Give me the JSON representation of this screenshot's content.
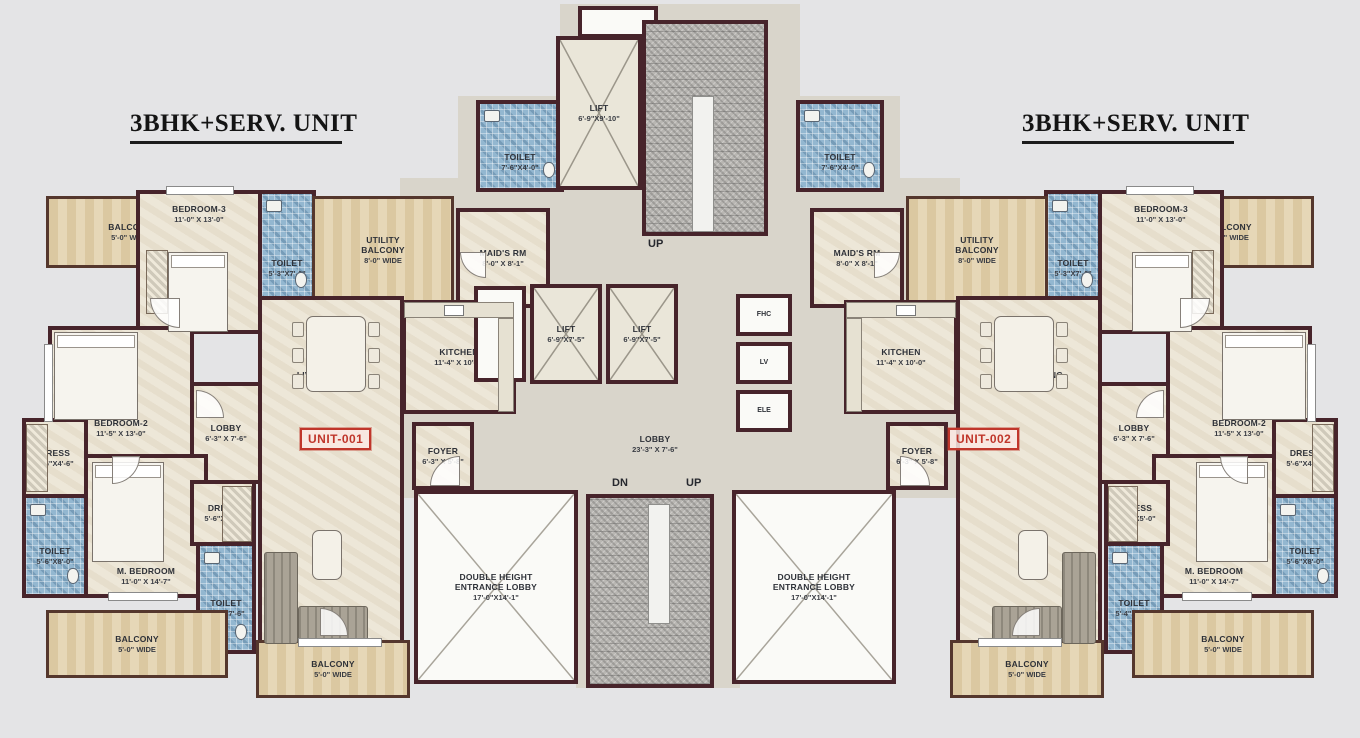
{
  "titles": {
    "left": "3BHK+SERV. UNIT",
    "right": "3BHK+SERV. UNIT"
  },
  "units": {
    "left": "UNIT-001",
    "right": "UNIT-002"
  },
  "colors": {
    "wall": "#47242b",
    "floor": "#ebe4d4",
    "balcony": "#e3d2ad",
    "toilet_tile": "#93b7d0",
    "stairs": "#b8b6b2",
    "hall": "#d9d5cb",
    "unit_tag_red": "#c0362b",
    "background": "#e4e4e6"
  },
  "core": {
    "lift_top": {
      "name": "LIFT",
      "dims": "6'-9\"X9'-10\""
    },
    "lift_small": {
      "name": "LIFT",
      "dims": "6'-9\"X7'-5\""
    },
    "lobby": {
      "name": "LOBBY",
      "dims": "23'-3\" X 7'-6\""
    },
    "entrance_lobby": {
      "l1": "DOUBLE HEIGHT",
      "l2": "ENTRANCE LOBBY",
      "dims": "17'-0\"X14'-1\""
    },
    "stairs_up_top": "UP",
    "stairs_dn": "DN",
    "stairs_up_bottom": "UP",
    "fhc": "FHC",
    "lv": "LV",
    "ele": "ELE",
    "maid_toilet": {
      "name": "TOILET",
      "dims": "7'-6\"X4'-0\""
    }
  },
  "rooms": {
    "balcony5": {
      "name": "BALCONY",
      "dims": "5'-0\" WIDE"
    },
    "bedroom3": {
      "name": "BEDROOM-3",
      "dims": "11'-0\" X 13'-0\""
    },
    "toilet_b3": {
      "name": "TOILET",
      "dims": "5'-3\"X7'-6\""
    },
    "utility": {
      "l1": "UTILITY",
      "l2": "BALCONY",
      "dims": "8'-0\" WIDE"
    },
    "maids": {
      "name": "MAID'S RM",
      "dims": "8'-0\" X 8'-1\""
    },
    "kitchen": {
      "name": "KITCHEN",
      "dims": "11'-4\" X 10'-0\""
    },
    "living": {
      "name": "LIVING / DINING",
      "dims": "14'-0\" X 27'-7\""
    },
    "foyer": {
      "name": "FOYER",
      "dims": "6'-3\" X 5'-8\""
    },
    "lobby_unit": {
      "name": "LOBBY",
      "dims": "6'-3\" X 7'-6\""
    },
    "bedroom2": {
      "name": "BEDROOM-2",
      "dims": "11'-5\" X 13'-0\""
    },
    "dress1": {
      "name": "DRESS",
      "dims": "5'-6\"X4'-6\""
    },
    "mbedroom": {
      "name": "M. BEDROOM",
      "dims": "11'-0\" X 14'-7\""
    },
    "toilet_mb": {
      "name": "TOILET",
      "dims": "5'-6\"X8'-0\""
    },
    "dress2": {
      "name": "DRESS",
      "dims": "5'-6\"X5'-0\""
    },
    "toilet_d": {
      "name": "TOILET",
      "dims": "5'-4\"X7'-6\""
    }
  }
}
